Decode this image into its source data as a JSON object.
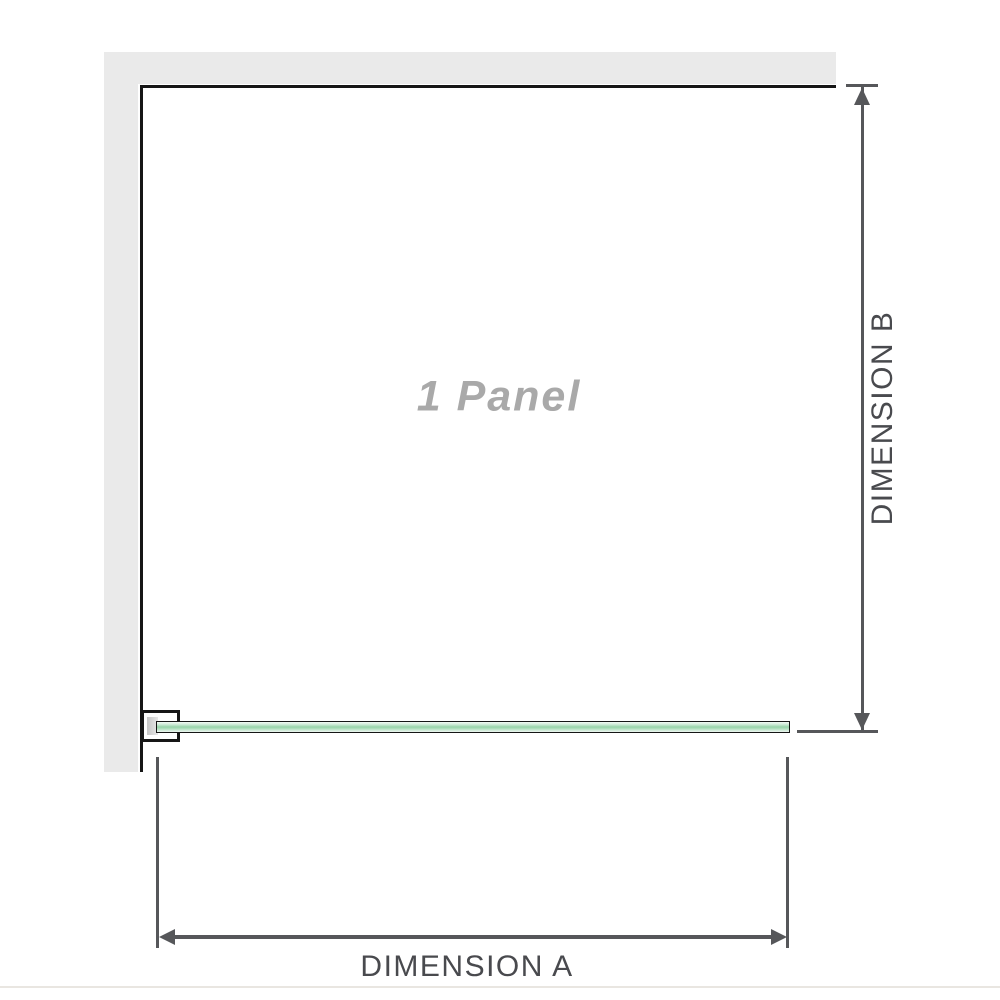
{
  "diagram": {
    "title": "1 Panel shower screen plan diagram",
    "panel_label": "1 Panel",
    "dimension_a_label": "DIMENSION A",
    "dimension_b_label": "DIMENSION B"
  },
  "colors": {
    "background": "#ffffff",
    "wall_fill": "#eaeaea",
    "screen_outline": "#161616",
    "dimension_line": "#56575a",
    "dimension_text": "#494a4e",
    "panel_watermark_text": "#a9a9a9",
    "glass_green_light": "#eef7f1",
    "glass_green_mid": "#97d3a9",
    "bracket_fill": "#ffffff",
    "bracket_inner_gray": "#c6c6c6",
    "faint_rule": "#e9e6e1"
  }
}
